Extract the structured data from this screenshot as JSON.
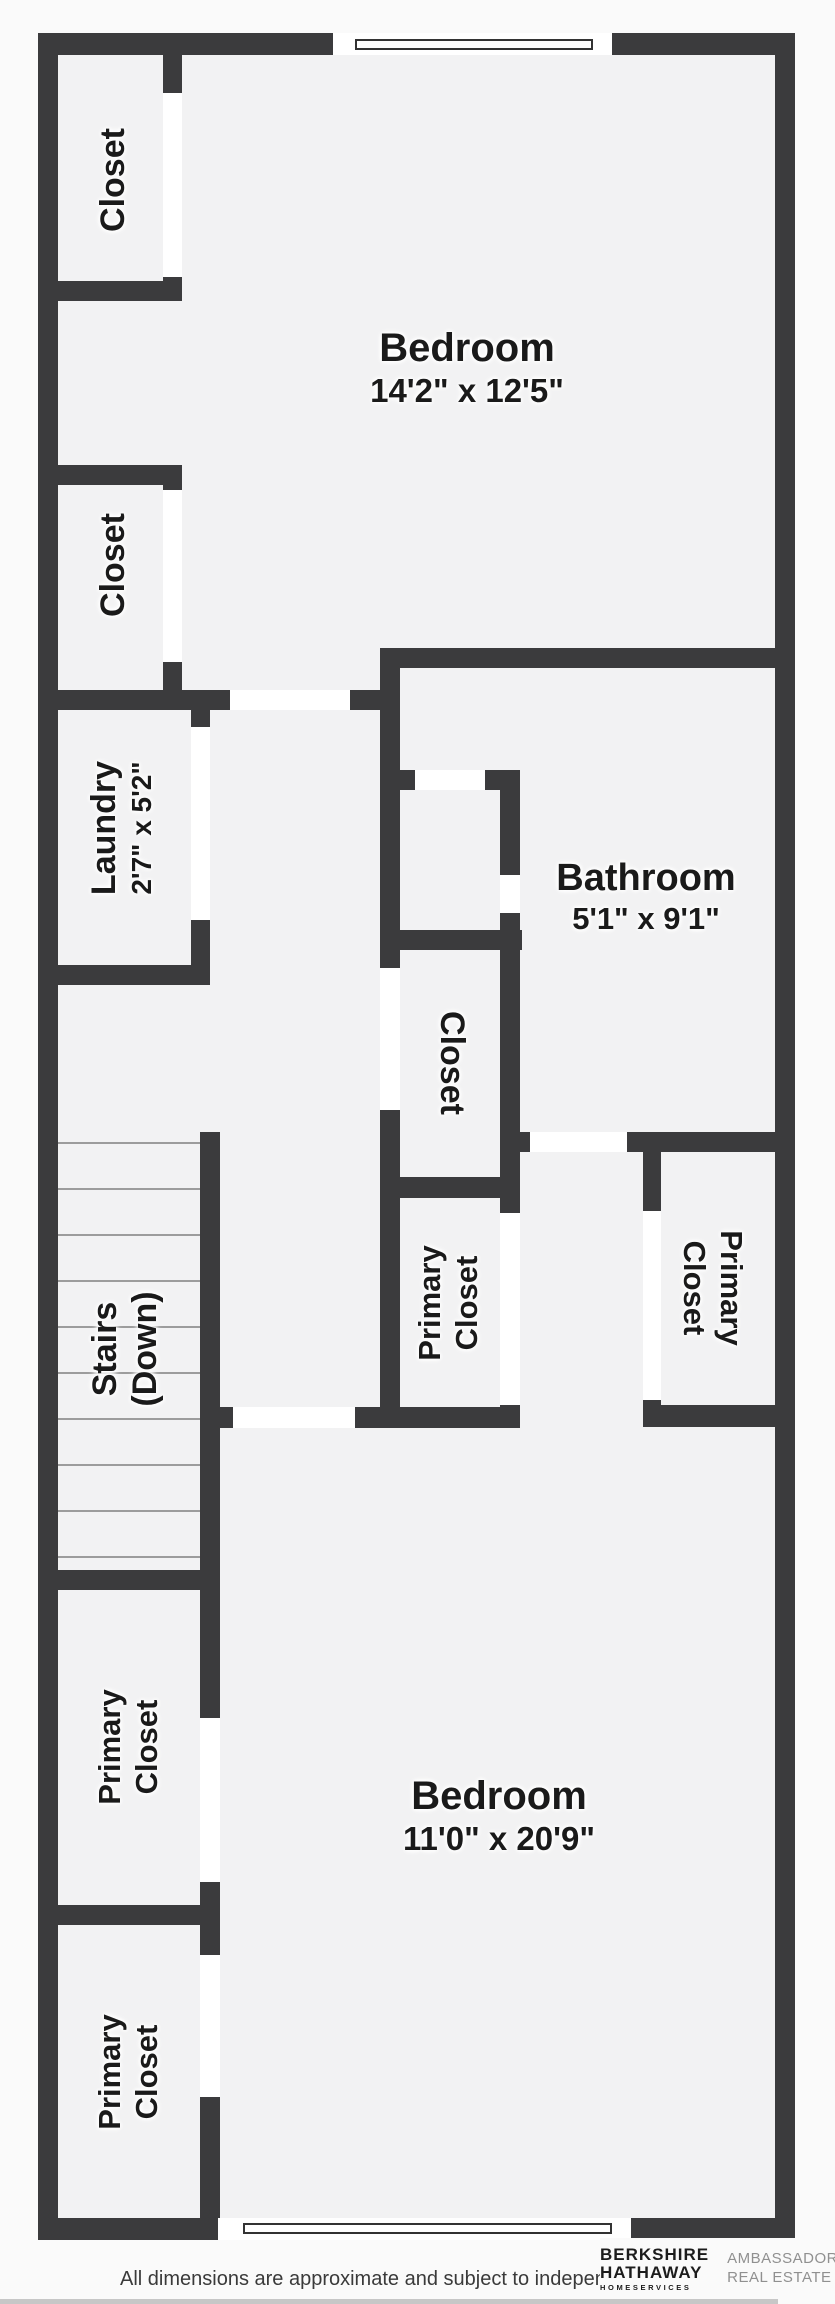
{
  "rooms": {
    "closet_a": {
      "label": "Closet"
    },
    "closet_b": {
      "label": "Closet"
    },
    "laundry": {
      "label": "Laundry",
      "dims": "2'7\" x 5'2\""
    },
    "bedroom_top": {
      "label": "Bedroom",
      "dims": "14'2\" x 12'5\""
    },
    "bathroom": {
      "label": "Bathroom",
      "dims": "5'1\" x 9'1\""
    },
    "closet_mid": {
      "label": "Closet"
    },
    "primary_closet_mid": {
      "line1": "Primary",
      "line2": "Closet"
    },
    "primary_closet_right": {
      "line1": "Primary",
      "line2": "Closet"
    },
    "stairs": {
      "line1": "Stairs",
      "line2": "(Down)"
    },
    "primary_closet_b1": {
      "line1": "Primary",
      "line2": "Closet"
    },
    "primary_closet_b2": {
      "line1": "Primary",
      "line2": "Closet"
    },
    "bedroom_bottom": {
      "label": "Bedroom",
      "dims": "11'0\" x 20'9\""
    }
  },
  "footer": {
    "disclaimer": "All dimensions are approximate and subject to independent",
    "logo": {
      "brand_line1": "BERKSHIRE",
      "brand_line2": "HATHAWAY",
      "brand_line3": "HOMESERVICES",
      "agency_line1": "AMBASSADOR",
      "agency_line2": "REAL ESTATE"
    }
  },
  "colors": {
    "wall": "#3b3b3d",
    "floor": "#f2f2f3",
    "page_bg": "#fafafa",
    "door_opening": "#ffffff",
    "window_line": "#333333",
    "step_line": "#9c9c9c",
    "label_text": "#1a1a1a",
    "logo_dark": "#1c1c1c",
    "logo_gray": "#909090",
    "bottom_bar": "#c7c7c7"
  }
}
